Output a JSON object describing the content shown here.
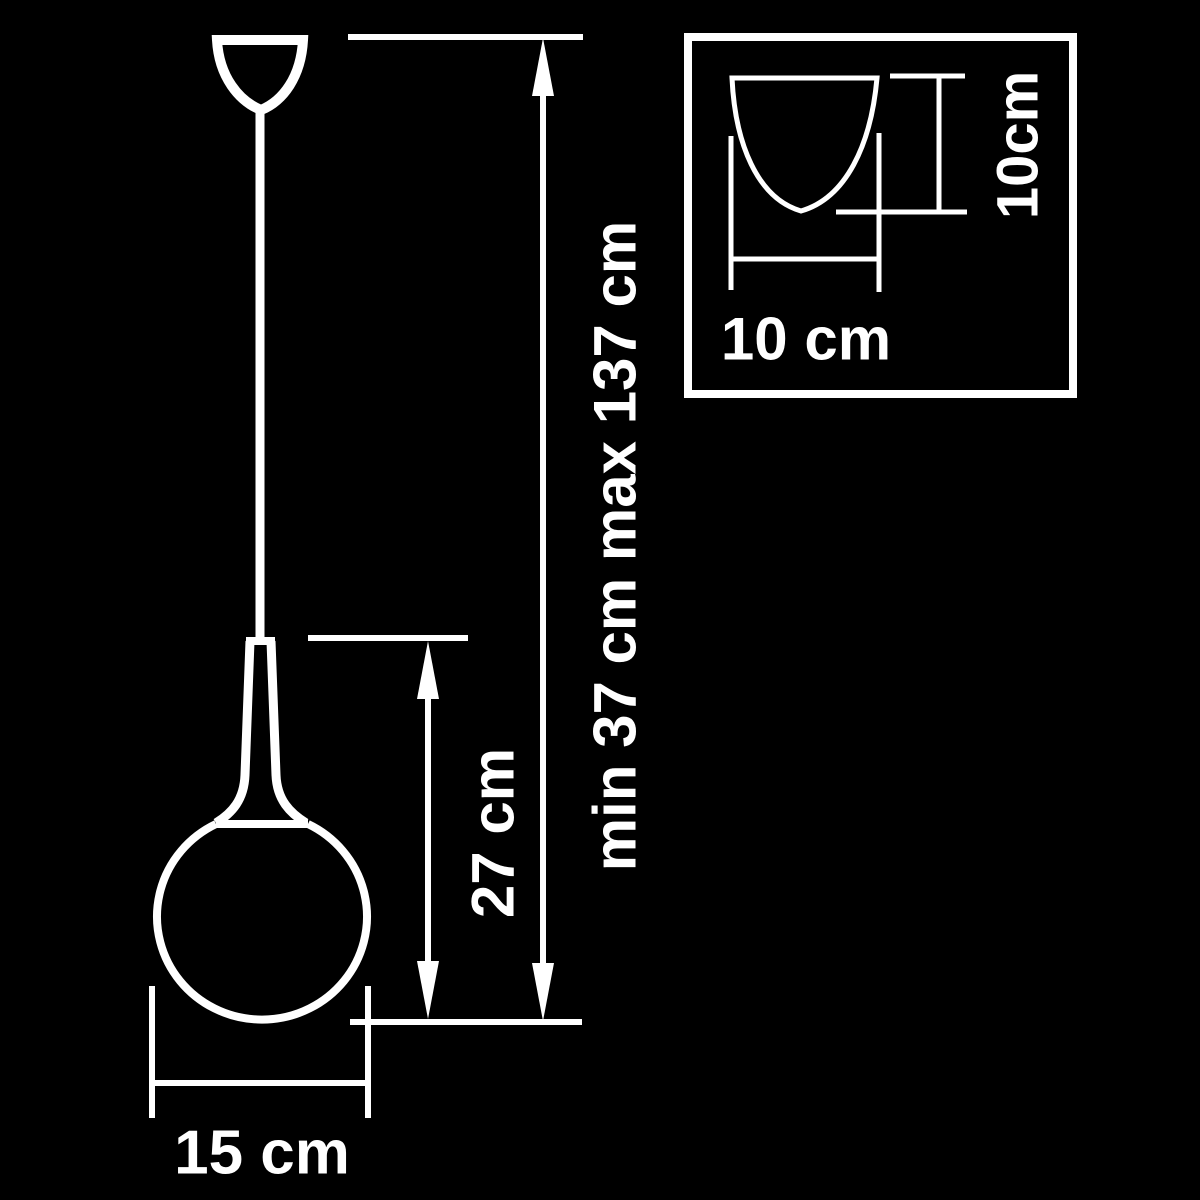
{
  "colors": {
    "background": "#000000",
    "line": "#ffffff"
  },
  "diagram": {
    "type": "product-dimension-drawing",
    "subject": "pendant-lamp",
    "labels": {
      "overall_height": "min 37 cm max 137 cm",
      "lamp_body_height": "27 cm",
      "globe_diameter": "15 cm",
      "inset_shade_width": "10 cm",
      "inset_shade_height": "10cm"
    }
  }
}
